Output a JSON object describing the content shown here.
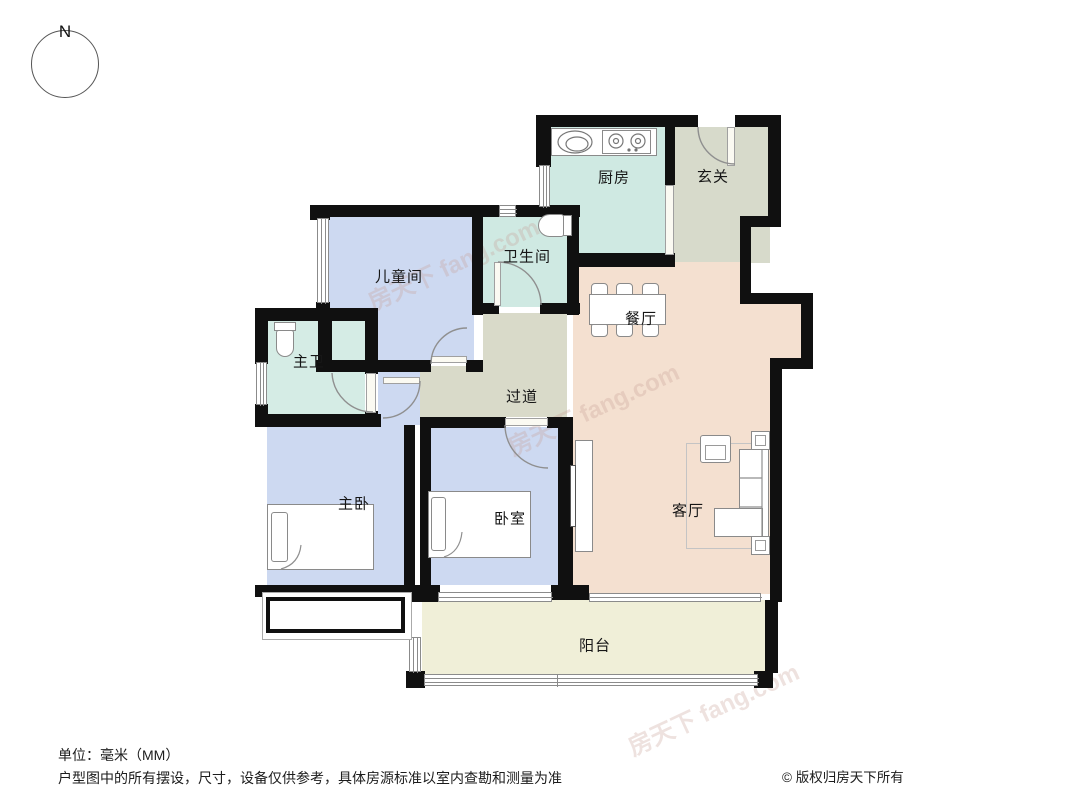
{
  "compass": {
    "label": "N"
  },
  "rooms": {
    "kitchen": {
      "label": "厨房"
    },
    "entry": {
      "label": "玄关"
    },
    "bathroom": {
      "label": "卫生间"
    },
    "children_room": {
      "label": "儿童间"
    },
    "dining": {
      "label": "餐厅"
    },
    "master_bath": {
      "label": "主卫"
    },
    "corridor": {
      "label": "过道"
    },
    "master_bedroom": {
      "label": "主卧"
    },
    "bedroom": {
      "label": "卧室"
    },
    "living_room": {
      "label": "客厅"
    },
    "balcony": {
      "label": "阳台"
    }
  },
  "watermark": {
    "text": "房天下 fang.com"
  },
  "footer": {
    "unit_note": "单位：毫米（MM）",
    "disclaimer": "户型图中的所有摆设，尺寸，设备仅供参考，具体房源标准以室内查勘和测量为准",
    "copyright": "© 版权归房天下所有"
  },
  "colors": {
    "wall": "#101010",
    "bedroom_blue": "#cdd9f1",
    "bath_teal": "#cfe9e2",
    "entry_green": "#d7dacb",
    "corridor_green": "#d9dac9",
    "living_peach": "#f4e0d0",
    "balcony_cream": "#f0efd8"
  }
}
